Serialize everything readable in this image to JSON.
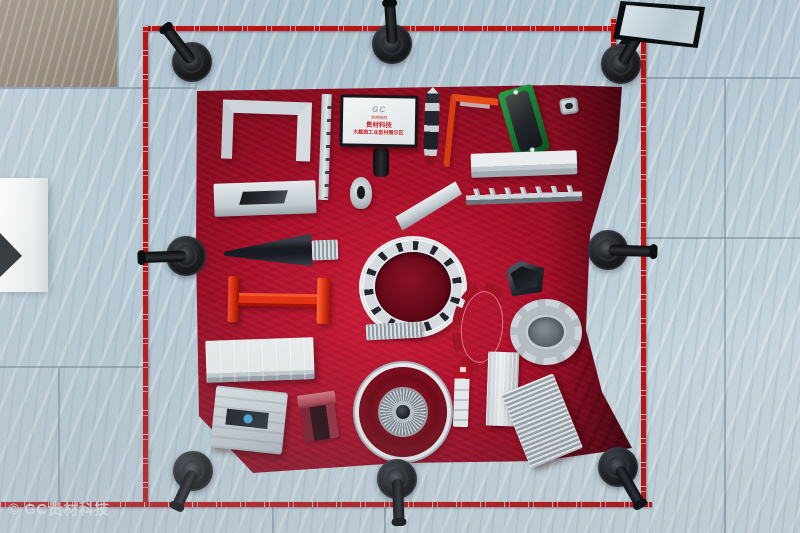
{
  "scene": {
    "watermark": "© GC贵材科技",
    "sign": {
      "logo": "GC",
      "logo_caption": "贵材铝材",
      "title": "贵材科技",
      "subtitle": "大截面工业型材展示区"
    }
  },
  "palette": {
    "table_red": "#a80e28",
    "tape_red": "#b81517",
    "floor_marble": "#b8cbd6",
    "stanchion_black": "#17191c",
    "aluminum_silver": "#d5dbdf",
    "anodized_green": "#1f8a3a",
    "beam_red_orange": "#e03415",
    "sign_text_red": "#c0242c"
  },
  "display_items": [
    {
      "name": "u-channel-profile",
      "kind": "u-channel",
      "x": 222,
      "y": 101,
      "w": 64,
      "h": 46,
      "rot": 2
    },
    {
      "name": "notched-rail-profile",
      "kind": "rail",
      "x": 320,
      "y": 94,
      "w": 10,
      "h": 106,
      "rot": 2
    },
    {
      "name": "boat-profile",
      "kind": "boat",
      "x": 424,
      "y": 87,
      "w": 15,
      "h": 80,
      "rot": 2
    },
    {
      "name": "orange-angle-profile",
      "kind": "angle",
      "x": 447,
      "y": 96,
      "w": 42,
      "h": 66,
      "rot": 6
    },
    {
      "name": "green-heatsink-plate",
      "kind": "green-plate",
      "x": 506,
      "y": 87,
      "w": 36,
      "h": 68,
      "rot": -16
    },
    {
      "name": "square-fitting",
      "kind": "square-fit",
      "x": 560,
      "y": 98,
      "w": 18,
      "h": 16,
      "rot": -8
    },
    {
      "name": "flat-slot-profile",
      "kind": "flat-slot",
      "x": 214,
      "y": 182,
      "w": 102,
      "h": 33,
      "rot": -2
    },
    {
      "name": "omega-tube-profile",
      "kind": "tube-small",
      "x": 350,
      "y": 177,
      "w": 22,
      "h": 32,
      "rot": 0
    },
    {
      "name": "blade-profile",
      "kind": "blade",
      "x": 394,
      "y": 196,
      "w": 70,
      "h": 20,
      "rot": -27
    },
    {
      "name": "long-flat-profile",
      "kind": "long-flat",
      "x": 471,
      "y": 152,
      "w": 106,
      "h": 24,
      "rot": -2
    },
    {
      "name": "serrated-rail-profile",
      "kind": "serrated",
      "x": 466,
      "y": 187,
      "w": 116,
      "h": 16,
      "rot": -2
    },
    {
      "name": "wing-wedge-profile",
      "kind": "wedge",
      "x": 224,
      "y": 235,
      "w": 88,
      "h": 33,
      "rot": -2
    },
    {
      "name": "wedge-connector-strip",
      "kind": "corrugated",
      "x": 312,
      "y": 240,
      "w": 26,
      "h": 20,
      "rot": -2
    },
    {
      "name": "slotted-ring-profile",
      "kind": "ring",
      "x": 362,
      "y": 239,
      "w": 102,
      "h": 96,
      "rot": 0
    },
    {
      "name": "red-ibeam-profile",
      "kind": "ibeam",
      "x": 228,
      "y": 277,
      "w": 102,
      "h": 46,
      "rot": 1
    },
    {
      "name": "curved-arc-profile",
      "kind": "arc",
      "x": 452,
      "y": 282,
      "w": 42,
      "h": 72,
      "rot": 6
    },
    {
      "name": "pentagon-tube-profile",
      "kind": "pent",
      "x": 505,
      "y": 260,
      "w": 40,
      "h": 35,
      "rot": -6
    },
    {
      "name": "gear-ring-profile",
      "kind": "gear",
      "x": 510,
      "y": 299,
      "w": 58,
      "h": 52,
      "rot": 0
    },
    {
      "name": "white-panel-profile",
      "kind": "big-panel",
      "x": 206,
      "y": 339,
      "w": 108,
      "h": 42,
      "rot": -2
    },
    {
      "name": "corrugated-strip",
      "kind": "corrugated",
      "x": 366,
      "y": 323,
      "w": 56,
      "h": 16,
      "rot": -3
    },
    {
      "name": "slotted-panel-profile",
      "kind": "slotted-wide",
      "x": 213,
      "y": 389,
      "w": 72,
      "h": 62,
      "rot": 6
    },
    {
      "name": "pink-bracket-profile",
      "kind": "red-bracket",
      "x": 302,
      "y": 393,
      "w": 34,
      "h": 47,
      "rot": -8
    },
    {
      "name": "finned-motor-housing",
      "kind": "fin-circle",
      "x": 359,
      "y": 367,
      "w": 88,
      "h": 90,
      "rot": 0
    },
    {
      "name": "labeled-sample-strip",
      "kind": "label-strip",
      "x": 454,
      "y": 365,
      "w": 15,
      "h": 62,
      "rot": 2
    },
    {
      "name": "ribbed-block-profile",
      "kind": "block-vert",
      "x": 487,
      "y": 352,
      "w": 31,
      "h": 74,
      "rot": 2
    },
    {
      "name": "finned-heatsink-plate",
      "kind": "fins-plate",
      "x": 514,
      "y": 381,
      "w": 56,
      "h": 80,
      "rot": -22
    }
  ],
  "stanchions": [
    {
      "name": "stanchion-top-left",
      "cx": 192,
      "cy": 62,
      "dir": -38,
      "len": 44
    },
    {
      "name": "stanchion-top-middle",
      "cx": 392,
      "cy": 44,
      "dir": -4,
      "len": 42
    },
    {
      "name": "stanchion-top-right",
      "cx": 621,
      "cy": 64,
      "dir": 30,
      "len": 36
    },
    {
      "name": "stanchion-middle-left",
      "cx": 186,
      "cy": 256,
      "dir": -92,
      "len": 46
    },
    {
      "name": "stanchion-middle-right",
      "cx": 608,
      "cy": 250,
      "dir": 92,
      "len": 46
    },
    {
      "name": "stanchion-bottom-left",
      "cx": 193,
      "cy": 471,
      "dir": -155,
      "len": 40
    },
    {
      "name": "stanchion-bottom-middle",
      "cx": 397,
      "cy": 479,
      "dir": 178,
      "len": 44
    },
    {
      "name": "stanchion-bottom-right",
      "cx": 618,
      "cy": 467,
      "dir": 150,
      "len": 44
    }
  ],
  "tapes": [
    {
      "name": "barrier-tape-top",
      "x": 146,
      "y": 26,
      "len": 468,
      "orient": "h"
    },
    {
      "name": "barrier-tape-left",
      "x": 143,
      "y": 26,
      "len": 478,
      "orient": "v"
    },
    {
      "name": "barrier-tape-right",
      "x": 641,
      "y": 30,
      "len": 474,
      "orient": "v"
    },
    {
      "name": "barrier-tape-bottom",
      "x": 0,
      "y": 502,
      "len": 652,
      "orient": "h"
    },
    {
      "name": "barrier-tape-corner-stub",
      "x": 611,
      "y": 18,
      "len": 46,
      "orient": "v"
    }
  ]
}
